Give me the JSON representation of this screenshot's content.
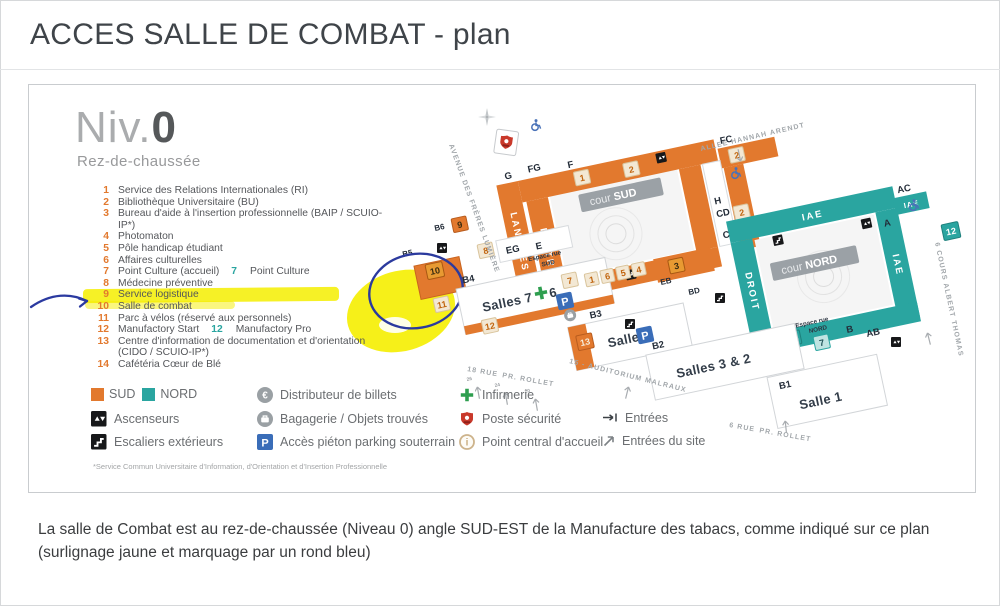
{
  "page": {
    "title": "ACCES SALLE DE COMBAT - plan",
    "caption": "La salle de Combat est au rez-de-chaussée (Niveau 0) angle SUD-EST de la Manufacture des tabacs, comme indiqué sur ce plan (surlignage jaune et marquage par un rond bleu)"
  },
  "plan": {
    "level": {
      "prefix": "Niv.",
      "number": "0",
      "subtitle": "Rez-de-chaussée"
    },
    "directory": [
      {
        "num": "1",
        "label": "Service des Relations Internationales (RI)"
      },
      {
        "num": "2",
        "label": "Bibliothèque Universitaire (BU)"
      },
      {
        "num": "3",
        "label": "Bureau d'aide à l'insertion professionnelle (BAIP / SCUIO-IP*)"
      },
      {
        "num": "4",
        "label": "Photomaton"
      },
      {
        "num": "5",
        "label": "Pôle handicap étudiant"
      },
      {
        "num": "6",
        "label": "Affaires culturelles"
      },
      {
        "num": "7",
        "label": "Point Culture (accueil)",
        "num2": "7",
        "label2": "Point Culture"
      },
      {
        "num": "8",
        "label": "Médecine préventive"
      },
      {
        "num": "9",
        "label": "Service logistique"
      },
      {
        "num": "10",
        "label": "Salle de combat"
      },
      {
        "num": "11",
        "label": "Parc à vélos (réservé aux personnels)"
      },
      {
        "num": "12",
        "label": "Manufactory Start",
        "num2": "12",
        "label2": "Manufactory Pro"
      },
      {
        "num": "13",
        "label": "Centre d'information de documentation et d'orientation",
        "sub": "(CIDO / SCUIO-IP*)"
      },
      {
        "num": "14",
        "label": "Cafétéria Cœur de Blé"
      }
    ],
    "legend": {
      "sud": "SUD",
      "nord": "NORD",
      "ascenseurs": "Ascenseurs",
      "escaliers": "Escaliers extérieurs",
      "distributeur": "Distributeur de billets",
      "bagagerie": "Bagagerie / Objets trouvés",
      "parking": "Accès piéton parking souterrain",
      "infirmerie": "Infirmerie",
      "securite": "Poste sécurité",
      "accueil": "Point central d'accueil",
      "entrees": "Entrées",
      "entrees_site": "Entrées du site"
    },
    "icons": {
      "parking_glyph": "P",
      "euro_glyph": "€",
      "info_glyph": "i"
    },
    "footnote": "*Service Commun Universitaire d'Information, d'Orientation et d'Insertion Professionnelle"
  },
  "map": {
    "zones": {
      "fg": "FG",
      "f": "F",
      "g": "G",
      "fc": "FC",
      "h": "H",
      "eg": "EG",
      "e": "E",
      "eb": "EB",
      "bd": "BD",
      "cd": "CD",
      "c": "C",
      "ac": "AC",
      "a": "A",
      "ab": "AB",
      "b": "B",
      "b1": "B1",
      "b2": "B2",
      "b3": "B3",
      "b4": "B4",
      "b5": "B5",
      "b6": "B6"
    },
    "bands": {
      "langues": "LANGUES",
      "lettres": "LETTRES",
      "droit": "DROIT",
      "iae": "IAE",
      "iae_top": "IAE",
      "iae_small": "IAE"
    },
    "courtyards": {
      "sud_light": "cour",
      "sud_bold": "SUD",
      "nord_light": "cour",
      "nord_bold": "NORD"
    },
    "salles": {
      "s76": "Salles 7 & 6",
      "s4": "Salle 4",
      "s32": "Salles 3 & 2",
      "s1": "Salle 1"
    },
    "espaces": {
      "sud1": "Espace rue",
      "sud2": "SUD",
      "nord1": "Espace rue",
      "nord2": "NORD"
    },
    "streets": {
      "arendt": "ALLEE HANNAH ARENDT",
      "lumiere": "AVENUE DES FRÈRES LUMIÈRE",
      "rollet18_light": "18 RUE",
      "rollet18_bold": "PR. ROLLET",
      "rollet6_light": "6 RUE",
      "rollet6_bold": "PR. ROLLET",
      "thomas": "6 COURS ALBERT THOMAS",
      "malraux": "15 - AUDITORIUM MALRAUX"
    },
    "markers": {
      "m1": "1",
      "m2a": "2",
      "m2b": "2",
      "m2c": "2",
      "m3": "3",
      "m4": "4",
      "m5": "5",
      "m6": "6",
      "m7a": "7",
      "m7b": "7",
      "m8": "8",
      "m9": "9",
      "m10": "10",
      "m11": "11",
      "m12a": "12",
      "m12c": "12",
      "m13": "13",
      "m14": "14",
      "row1": "1"
    },
    "entry_numbers": {
      "e26": "26",
      "e24": "24",
      "e20": "20"
    }
  }
}
